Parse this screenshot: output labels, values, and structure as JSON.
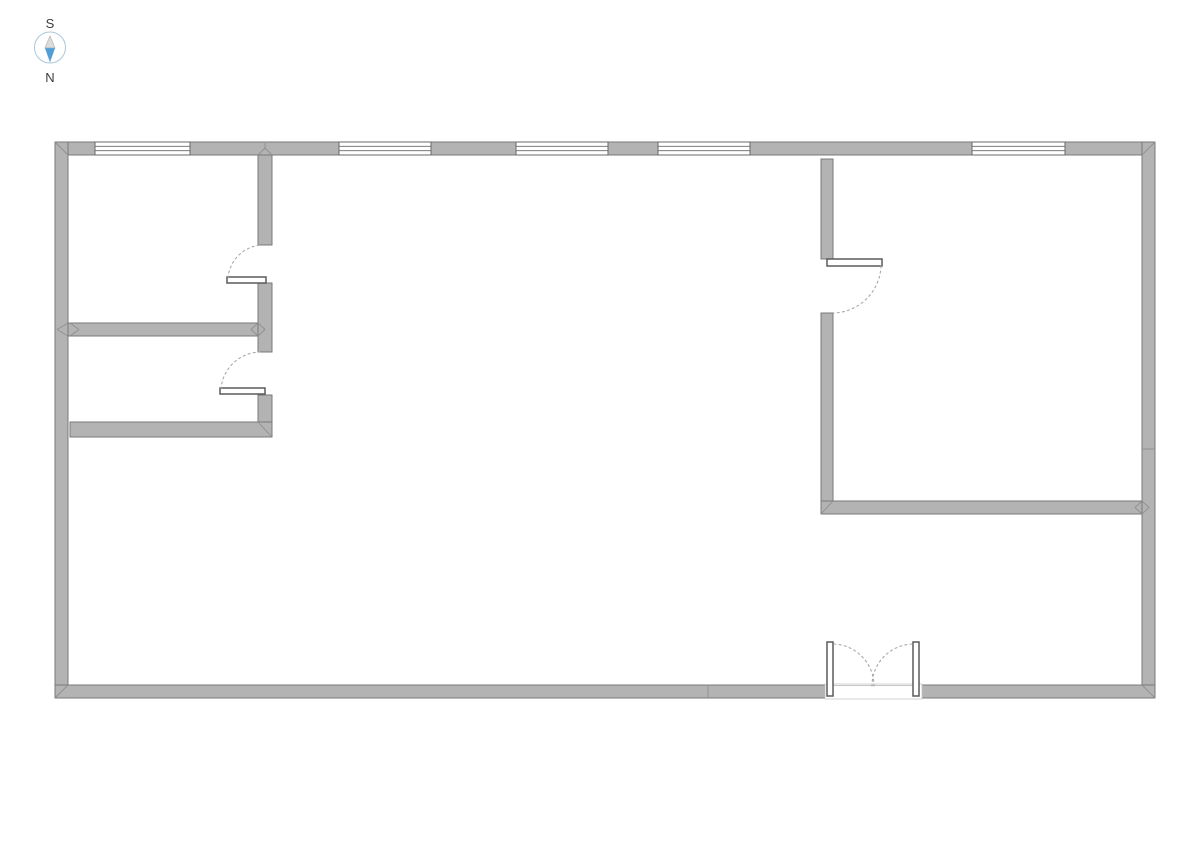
{
  "compass": {
    "south_label": "S",
    "north_label": "N",
    "ring_color": "#a9c7da",
    "needle_south_fill": "#dcdcdc",
    "needle_north_fill": "#4d9fd6",
    "label_color": "#3d3d3d"
  },
  "colors": {
    "background": "#ffffff",
    "wall_fill": "#b3b3b3",
    "wall_stroke": "#787878",
    "window_fill": "#ffffff",
    "window_stroke": "#696969",
    "door_leaf_fill": "#ffffff",
    "door_leaf_stroke": "#5a5a5a",
    "swing_arc": "#a8a8a8",
    "joint_line": "#8f8f8f",
    "threshold": "#c6c6c6"
  },
  "floor_plan": {
    "canvas": {
      "width": 1191,
      "height": 841
    },
    "walls": [
      {
        "name": "exterior-wall-top",
        "x": 55,
        "y": 142,
        "w": 1100,
        "h": 13
      },
      {
        "name": "exterior-wall-left",
        "x": 55,
        "y": 142,
        "w": 13,
        "h": 556
      },
      {
        "name": "exterior-wall-right",
        "x": 1142,
        "y": 142,
        "w": 13,
        "h": 556
      },
      {
        "name": "exterior-wall-bottom-west",
        "x": 55,
        "y": 685,
        "w": 770,
        "h": 13
      },
      {
        "name": "exterior-wall-bottom-east",
        "x": 921,
        "y": 685,
        "w": 234,
        "h": 13
      },
      {
        "name": "partition-nw-vertical-upper",
        "x": 258,
        "y": 155,
        "w": 14,
        "h": 90
      },
      {
        "name": "partition-nw-vertical-mid",
        "x": 258,
        "y": 283,
        "w": 14,
        "h": 69
      },
      {
        "name": "partition-nw-vertical-lower",
        "x": 258,
        "y": 395,
        "w": 14,
        "h": 27
      },
      {
        "name": "partition-nw-horizontal",
        "x": 68,
        "y": 323,
        "w": 190,
        "h": 13
      },
      {
        "name": "partition-sw-horizontal",
        "x": 70,
        "y": 422,
        "w": 202,
        "h": 15
      },
      {
        "name": "partition-ne-vertical-upper",
        "x": 821,
        "y": 159,
        "w": 12,
        "h": 100
      },
      {
        "name": "partition-ne-vertical-lower",
        "x": 821,
        "y": 313,
        "w": 12,
        "h": 188
      },
      {
        "name": "partition-ne-horizontal",
        "x": 821,
        "y": 501,
        "w": 321,
        "h": 13
      }
    ],
    "windows": [
      {
        "name": "window-1",
        "x": 95,
        "y": 142,
        "w": 95,
        "h": 13
      },
      {
        "name": "window-2",
        "x": 339,
        "y": 142,
        "w": 92,
        "h": 13
      },
      {
        "name": "window-3",
        "x": 516,
        "y": 142,
        "w": 92,
        "h": 13
      },
      {
        "name": "window-4",
        "x": 658,
        "y": 142,
        "w": 92,
        "h": 13
      },
      {
        "name": "window-5",
        "x": 972,
        "y": 142,
        "w": 93,
        "h": 13
      }
    ],
    "doors": [
      {
        "name": "door-nw-upper-room",
        "leaf": {
          "x": 227,
          "y": 277,
          "w": 39,
          "h": 6
        },
        "arc": "M 228 278 A 36 36 0 0 1 262 245"
      },
      {
        "name": "door-sw-room",
        "leaf": {
          "x": 220,
          "y": 388,
          "w": 45,
          "h": 6
        },
        "arc": "M 221 389 A 40 40 0 0 1 260 352"
      },
      {
        "name": "door-ne-room",
        "leaf": {
          "x": 827,
          "y": 259,
          "w": 55,
          "h": 7
        },
        "arc": "M 881 266 A 49 49 0 0 1 834 313"
      },
      {
        "name": "double-door-left",
        "leaf": {
          "x": 827,
          "y": 642,
          "w": 6,
          "h": 54
        },
        "arc": "M 834 644 A 42 42 0 0 1 874 686"
      },
      {
        "name": "double-door-right",
        "leaf": {
          "x": 913,
          "y": 642,
          "w": 6,
          "h": 54
        },
        "arc": "M 912 644 A 42 42 0 0 0 872 686"
      }
    ],
    "double_door": {
      "opening": {
        "x": 825,
        "y": 684,
        "w": 97,
        "h": 15
      },
      "threshold": {
        "x1": 833,
        "y1": 685.5,
        "x2": 913,
        "y2": 685.5
      }
    },
    "joints": [
      {
        "name": "corner-miter-top-left",
        "x1": 55,
        "y1": 142,
        "x2": 68,
        "y2": 155
      },
      {
        "name": "corner-miter-top-right",
        "x1": 1155,
        "y1": 142,
        "x2": 1142,
        "y2": 155
      },
      {
        "name": "corner-miter-bottom-left",
        "x1": 55,
        "y1": 698,
        "x2": 68,
        "y2": 685
      },
      {
        "name": "corner-miter-bottom-right",
        "x1": 1155,
        "y1": 698,
        "x2": 1142,
        "y2": 685
      },
      {
        "name": "tee-miter-top-wall-a",
        "x1": 258,
        "y1": 155,
        "x2": 265,
        "y2": 148
      },
      {
        "name": "tee-miter-top-wall-b",
        "x1": 265,
        "y1": 148,
        "x2": 272,
        "y2": 155
      },
      {
        "name": "tee-miter-top-wall-c",
        "x1": 265,
        "y1": 143,
        "x2": 265,
        "y2": 148
      },
      {
        "name": "joint-left-wall-a",
        "x1": 68,
        "y1": 323,
        "x2": 57,
        "y2": 329.5
      },
      {
        "name": "joint-left-wall-b",
        "x1": 57,
        "y1": 329.5,
        "x2": 68,
        "y2": 336
      },
      {
        "name": "joint-left-wall-c",
        "x1": 70,
        "y1": 323,
        "x2": 79,
        "y2": 329.5
      },
      {
        "name": "joint-left-wall-d",
        "x1": 79,
        "y1": 329.5,
        "x2": 70,
        "y2": 336
      },
      {
        "name": "joint-partition-a",
        "x1": 258,
        "y1": 323,
        "x2": 251,
        "y2": 329.5
      },
      {
        "name": "joint-partition-b",
        "x1": 251,
        "y1": 329.5,
        "x2": 258,
        "y2": 336
      },
      {
        "name": "joint-partition-c",
        "x1": 258,
        "y1": 323,
        "x2": 265,
        "y2": 329.5
      },
      {
        "name": "joint-partition-d",
        "x1": 265,
        "y1": 329.5,
        "x2": 258,
        "y2": 336
      },
      {
        "name": "corner-miter-sw-room",
        "x1": 258,
        "y1": 422,
        "x2": 272,
        "y2": 437
      },
      {
        "name": "corner-miter-ne-room",
        "x1": 833,
        "y1": 501,
        "x2": 821,
        "y2": 514
      },
      {
        "name": "joint-right-wall-a",
        "x1": 1142,
        "y1": 501,
        "x2": 1135,
        "y2": 507.5
      },
      {
        "name": "joint-right-wall-b",
        "x1": 1135,
        "y1": 507.5,
        "x2": 1142,
        "y2": 514
      },
      {
        "name": "joint-right-wall-c",
        "x1": 1142,
        "y1": 501,
        "x2": 1149,
        "y2": 507.5
      },
      {
        "name": "joint-right-wall-d",
        "x1": 1149,
        "y1": 507.5,
        "x2": 1142,
        "y2": 514
      },
      {
        "name": "seam-bottom-wall",
        "x1": 708,
        "y1": 685,
        "x2": 708,
        "y2": 698
      },
      {
        "name": "seam-right-wall",
        "x1": 1142,
        "y1": 449,
        "x2": 1155,
        "y2": 449
      }
    ]
  }
}
